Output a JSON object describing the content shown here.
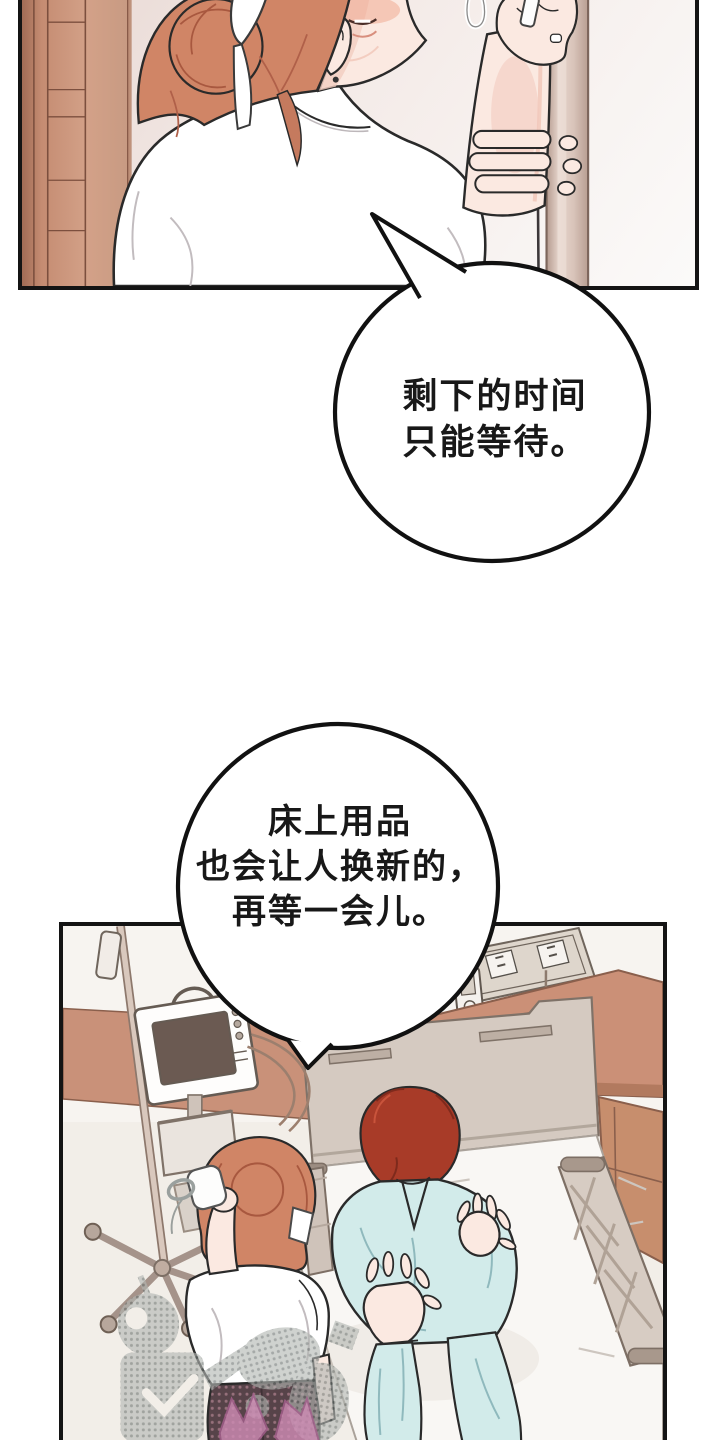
{
  "page": {
    "type": "webtoon-comic-page",
    "width": 720,
    "height": 1440,
    "background": "#ffffff"
  },
  "palette": {
    "page-bg": "#ffffff",
    "ink": "#141414",
    "panel1-bg-start": "#e8d8d3",
    "panel1-bg-end": "#fbfaf9",
    "wood-light": "#d3a188",
    "wood-dark": "#a06b55",
    "pole": "#d9c6bc",
    "skin": "#fbe9e1",
    "skin-shade": "#f3cdc0",
    "blush": "#f0ab94",
    "nurse-hair": "#d08566",
    "nurse-hair-dark": "#a8583f",
    "man-hair": "#a83b28",
    "man-hair-dark": "#7e2a1c",
    "scrubs": "#d2ebea",
    "scrubs-shade": "#8fb9bd",
    "headboard": "#d5cac1",
    "bed-sheet": "#f9f7f4",
    "cabinet": "#c78e6d",
    "wall-band": "#c99179",
    "outlet-panel": "#ded6cc",
    "monitor-screen": "#6b5a52",
    "pants-dark": "#574349",
    "watermark-gray": "#b3b7b3",
    "watermark-pink": "#cf8cb5",
    "bubble-fill": "#ffffff",
    "bubble-stroke": "#111111"
  },
  "panels": [
    {
      "id": "panel-top",
      "description": "Nurse with auburn bun and white ribbon looking up while adjusting an IV line on a pole beside a wooden cabinet"
    },
    {
      "id": "panel-bottom",
      "description": "Overhead view of hospital room: IV stand with patient monitor, nurse holding cuff, red-haired patient in pale blue scrubs sitting on bed, wall outlets and wooden cabinet"
    }
  ],
  "speech_bubbles": [
    {
      "speaker": "nurse",
      "lines": [
        "剩下的时间",
        "只能等待。"
      ]
    },
    {
      "speaker": "nurse",
      "lines": [
        "床上用品",
        "也会让人换新的，",
        "再等一会儿。"
      ]
    }
  ]
}
